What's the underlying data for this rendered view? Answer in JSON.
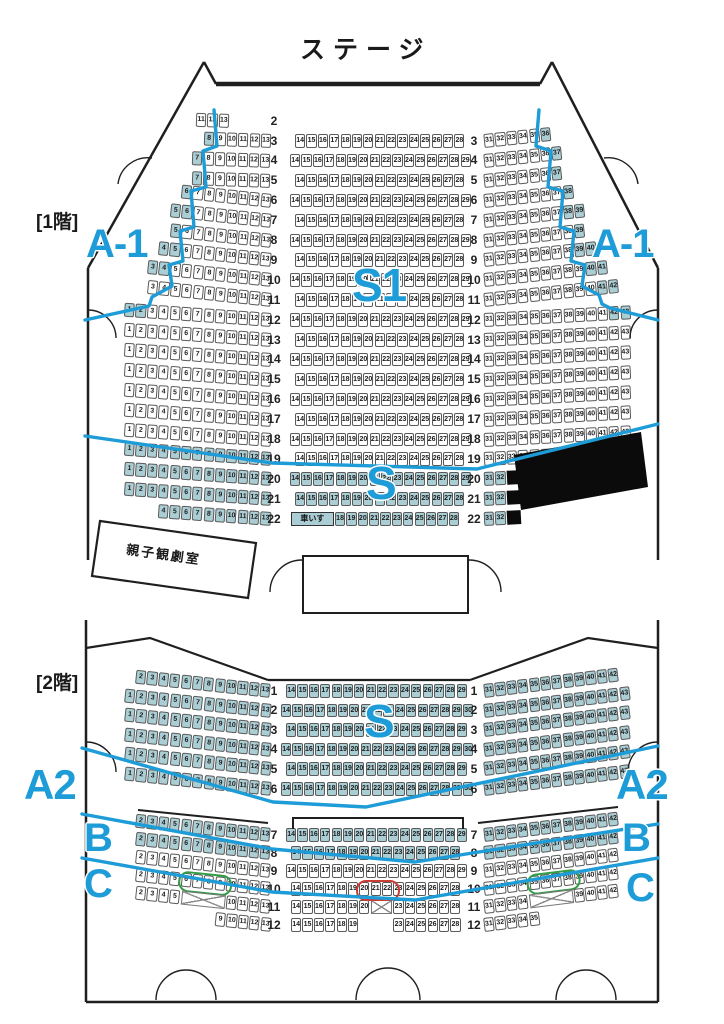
{
  "theme": {
    "teal": "#abced5",
    "blue": "#1e9cd7",
    "red": "#cc3b35",
    "green": "#2f9e44"
  },
  "strings": {
    "wheelchair": "車いす"
  },
  "labels": [
    {
      "n": "stage-label",
      "t": "ステージ",
      "x": 300,
      "y": 38,
      "s": 25,
      "c": "#1a1a1a",
      "ls": 8,
      "plain": true
    },
    {
      "n": "floor1-label",
      "t": "[1階]",
      "x": 36,
      "y": 213,
      "s": 19,
      "c": "#1a1a1a",
      "plain": true
    },
    {
      "n": "floor2-label",
      "t": "[2階]",
      "x": 36,
      "y": 674,
      "s": 19,
      "c": "#1a1a1a",
      "plain": true
    },
    {
      "n": "family-room-label",
      "t": "親子観劇室",
      "x": 126,
      "y": 548,
      "s": 13,
      "c": "#1a1a1a",
      "rot": 8,
      "ls": 2,
      "plain": true
    },
    {
      "n": "zone-a1-left",
      "t": "A-1",
      "x": 86,
      "y": 224,
      "s": 40
    },
    {
      "n": "zone-a1-right",
      "t": "A-1",
      "x": 592,
      "y": 224,
      "s": 40
    },
    {
      "n": "zone-s1",
      "t": "S1",
      "x": 352,
      "y": 262,
      "s": 46
    },
    {
      "n": "zone-s-floor1",
      "t": "S",
      "x": 366,
      "y": 460,
      "s": 46
    },
    {
      "n": "zone-s-floor2",
      "t": "S",
      "x": 364,
      "y": 698,
      "s": 46
    },
    {
      "n": "zone-a2-left",
      "t": "A2",
      "x": 24,
      "y": 764,
      "s": 42
    },
    {
      "n": "zone-a2-right",
      "t": "A2",
      "x": 616,
      "y": 764,
      "s": 42
    },
    {
      "n": "zone-b-left",
      "t": "B",
      "x": 84,
      "y": 818,
      "s": 40
    },
    {
      "n": "zone-b-right",
      "t": "B",
      "x": 622,
      "y": 818,
      "s": 40
    },
    {
      "n": "zone-c-left",
      "t": "C",
      "x": 84,
      "y": 864,
      "s": 40
    },
    {
      "n": "zone-c-right",
      "t": "C",
      "x": 626,
      "y": 868,
      "s": 40
    }
  ],
  "floors": [
    {
      "name": "1F",
      "rows": [
        {
          "n": "2",
          "y": 114,
          "lab": "L",
          "L": {
            "x": 196,
            "r": 2,
            "o": "R",
            "s": "11-13"
          }
        },
        {
          "n": "3",
          "y": 134,
          "lab": "LR",
          "L": {
            "x": 203.8,
            "r": 2,
            "o": "R",
            "s": "8-13",
            "hl": "8"
          },
          "C": {
            "x": 295,
            "s": "14-28"
          },
          "R": {
            "x": 484,
            "r": -6,
            "o": "L",
            "s": "31-36",
            "hl": "36"
          }
        },
        {
          "n": "4",
          "y": 153.9,
          "lab": "LR",
          "L": {
            "x": 192.4,
            "r": 2,
            "o": "R",
            "s": "7-13",
            "hl": "7"
          },
          "C": {
            "x": 290,
            "s": "14-29"
          },
          "R": {
            "x": 484,
            "r": -6,
            "o": "L",
            "s": "31-37",
            "hl": "37"
          }
        },
        {
          "n": "5",
          "y": 173.8,
          "lab": "LR",
          "L": {
            "x": 192.4,
            "r": 2,
            "o": "R",
            "s": "7-13",
            "hl": "7"
          },
          "C": {
            "x": 295,
            "s": "14-28"
          },
          "R": {
            "x": 484,
            "r": -6,
            "o": "L",
            "s": "31-37",
            "hl": "37"
          }
        },
        {
          "n": "6",
          "y": 193.7,
          "lab": "LR",
          "L": {
            "x": 181,
            "r": 6,
            "o": "R",
            "s": "6-13",
            "hl": "6"
          },
          "C": {
            "x": 290,
            "s": "14-29"
          },
          "R": {
            "x": 484,
            "r": -6,
            "o": "L",
            "s": "31-38",
            "hl": "38"
          }
        },
        {
          "n": "7",
          "y": 213.6,
          "lab": "LR",
          "L": {
            "x": 169.6,
            "r": 6,
            "o": "R",
            "s": "5-13",
            "hl": "5-6"
          },
          "C": {
            "x": 295,
            "s": "14-28"
          },
          "R": {
            "x": 484,
            "r": -6,
            "o": "L",
            "s": "31-39",
            "hl": "38-39"
          }
        },
        {
          "n": "8",
          "y": 233.5,
          "lab": "LR",
          "L": {
            "x": 169.6,
            "r": 6,
            "o": "R",
            "s": "5-13",
            "hl": "5"
          },
          "C": {
            "x": 290,
            "s": "14-29"
          },
          "R": {
            "x": 484,
            "r": -6,
            "o": "L",
            "s": "31-39",
            "hl": "39"
          }
        },
        {
          "n": "9",
          "y": 253.4,
          "lab": "LR",
          "L": {
            "x": 158.2,
            "r": 6,
            "o": "R",
            "s": "4-13",
            "hl": "4-5"
          },
          "C": {
            "x": 295,
            "s": "14-28"
          },
          "R": {
            "x": 484,
            "r": -6,
            "o": "L",
            "s": "31-40",
            "hl": "39-40"
          }
        },
        {
          "n": "10",
          "y": 273.3,
          "lab": "LR",
          "L": {
            "x": 146.8,
            "r": 6,
            "o": "R",
            "s": "3-13",
            "hl": "3-4"
          },
          "C": {
            "x": 290,
            "s": "14-29"
          },
          "R": {
            "x": 484,
            "r": -6,
            "o": "L",
            "s": "31-41",
            "hl": "40-41"
          }
        },
        {
          "n": "11",
          "y": 293.2,
          "lab": "LR",
          "L": {
            "x": 146.8,
            "r": 6,
            "o": "R",
            "s": "3-13"
          },
          "C": {
            "x": 295,
            "s": "14-28"
          },
          "R": {
            "x": 484,
            "r": -6,
            "o": "L",
            "s": "31-42",
            "hl": "41-42"
          }
        },
        {
          "n": "12",
          "y": 313.1,
          "lab": "LR",
          "L": {
            "x": 124,
            "r": 4,
            "o": "R",
            "s": "1-13",
            "hl": "1-2"
          },
          "C": {
            "x": 290,
            "s": "14-29"
          },
          "R": {
            "x": 484,
            "r": -3,
            "o": "L",
            "s": "31-43",
            "hl": "42-43"
          }
        },
        {
          "n": "13",
          "y": 333,
          "lab": "LR",
          "L": {
            "x": 124,
            "r": 4,
            "o": "R",
            "s": "1-13"
          },
          "C": {
            "x": 295,
            "s": "14-28"
          },
          "R": {
            "x": 484,
            "r": -3,
            "o": "L",
            "s": "31-43"
          }
        },
        {
          "n": "14",
          "y": 352.9,
          "lab": "LR",
          "L": {
            "x": 124,
            "r": 4,
            "o": "R",
            "s": "1-13"
          },
          "C": {
            "x": 290,
            "s": "14-29"
          },
          "R": {
            "x": 484,
            "r": -3,
            "o": "L",
            "s": "31-43"
          }
        },
        {
          "n": "15",
          "y": 372.8,
          "lab": "LR",
          "L": {
            "x": 124,
            "r": 4,
            "o": "R",
            "s": "1-13"
          },
          "C": {
            "x": 295,
            "s": "14-28"
          },
          "R": {
            "x": 484,
            "r": -3,
            "o": "L",
            "s": "31-43"
          }
        },
        {
          "n": "16",
          "y": 392.7,
          "lab": "LR",
          "L": {
            "x": 124,
            "r": 4,
            "o": "R",
            "s": "1-13"
          },
          "C": {
            "x": 290,
            "s": "14-29"
          },
          "R": {
            "x": 484,
            "r": -3,
            "o": "L",
            "s": "31-43"
          }
        },
        {
          "n": "17",
          "y": 412.6,
          "lab": "LR",
          "L": {
            "x": 124,
            "r": 4,
            "o": "R",
            "s": "1-13"
          },
          "C": {
            "x": 295,
            "s": "14-28"
          },
          "R": {
            "x": 484,
            "r": -3,
            "o": "L",
            "s": "31-43"
          }
        },
        {
          "n": "18",
          "y": 432.5,
          "lab": "LR",
          "L": {
            "x": 124,
            "r": 4,
            "o": "R",
            "s": "1-13"
          },
          "C": {
            "x": 290,
            "s": "14-29"
          },
          "R": {
            "x": 484,
            "r": -3,
            "o": "L",
            "s": "31-43"
          }
        },
        {
          "n": "19",
          "y": 452.4,
          "lab": "LR",
          "L": {
            "x": 124,
            "r": 4,
            "o": "R",
            "s": "1-13",
            "hl": "*"
          },
          "C": {
            "x": 295,
            "s": "14-28"
          },
          "R": {
            "x": 484,
            "r": -3,
            "o": "L",
            "s": "31-41"
          }
        },
        {
          "n": "20",
          "y": 472.3,
          "lab": "LR",
          "L": {
            "x": 124,
            "r": 4,
            "o": "R",
            "s": "1-13",
            "hl": "*"
          },
          "C": {
            "x": 290,
            "s": "14-29",
            "hl": "*"
          },
          "R": {
            "x": 484,
            "r": -3,
            "o": "L",
            "s": "31-32,B",
            "hl": "*"
          }
        },
        {
          "n": "21",
          "y": 492.2,
          "lab": "LR",
          "L": {
            "x": 124,
            "r": 4,
            "o": "R",
            "s": "1-13",
            "hl": "*"
          },
          "C": {
            "x": 295,
            "s": "14-28",
            "hl": "*"
          },
          "R": {
            "x": 484,
            "r": -3,
            "o": "L",
            "s": "31-32,B",
            "hl": "*"
          }
        },
        {
          "n": "22",
          "y": 512.1,
          "lab": "LR",
          "L": {
            "x": 158.2,
            "r": 4,
            "o": "R",
            "s": "4-13",
            "hl": "*"
          },
          "C": {
            "x": 291,
            "s": "W,18-28",
            "hl": "*"
          },
          "R": {
            "x": 484,
            "r": -3,
            "o": "L",
            "s": "31-32,B",
            "hl": "*"
          }
        }
      ]
    },
    {
      "name": "2F",
      "rows": [
        {
          "n": "1",
          "y": 684,
          "lab": "LR",
          "L": {
            "x": 135.4,
            "r": 6,
            "o": "R",
            "s": "2-13",
            "hl": "*"
          },
          "C": {
            "x": 286,
            "s": "14-29",
            "hl": "*"
          },
          "R": {
            "x": 484,
            "r": -7,
            "o": "L",
            "s": "31-42",
            "hl": "*"
          }
        },
        {
          "n": "2",
          "y": 703.6,
          "lab": "LR",
          "L": {
            "x": 124,
            "r": 6,
            "o": "R",
            "s": "1-13",
            "hl": "*"
          },
          "C": {
            "x": 281,
            "s": "14-30",
            "hl": "*"
          },
          "R": {
            "x": 484,
            "r": -7,
            "o": "L",
            "s": "31-43",
            "hl": "*"
          }
        },
        {
          "n": "3",
          "y": 723.2,
          "lab": "LR",
          "L": {
            "x": 124,
            "r": 6,
            "o": "R",
            "s": "1-13",
            "hl": "*"
          },
          "C": {
            "x": 286,
            "s": "14-29",
            "hl": "*"
          },
          "R": {
            "x": 484,
            "r": -7,
            "o": "L",
            "s": "31-43",
            "hl": "*"
          }
        },
        {
          "n": "4",
          "y": 742.8,
          "lab": "LR",
          "L": {
            "x": 124,
            "r": 6,
            "o": "R",
            "s": "1-13",
            "hl": "*"
          },
          "C": {
            "x": 281,
            "s": "14-30",
            "hl": "*"
          },
          "R": {
            "x": 484,
            "r": -7,
            "o": "L",
            "s": "31-43",
            "hl": "*"
          }
        },
        {
          "n": "5",
          "y": 762.4,
          "lab": "LR",
          "L": {
            "x": 124,
            "r": 6,
            "o": "R",
            "s": "1-13",
            "hl": "*"
          },
          "C": {
            "x": 286,
            "s": "14-29",
            "hl": "*"
          },
          "R": {
            "x": 484,
            "r": -7,
            "o": "L",
            "s": "31-43",
            "hl": "*"
          }
        },
        {
          "n": "6",
          "y": 782,
          "lab": "LR",
          "L": {
            "x": 124,
            "r": 6,
            "o": "R",
            "s": "1-13",
            "hl": "*"
          },
          "C": {
            "x": 281,
            "s": "14-30",
            "hl": "*"
          },
          "R": {
            "x": 484,
            "r": -7,
            "o": "L",
            "s": "31-43",
            "hl": "*"
          }
        },
        {
          "n": "7",
          "y": 828,
          "lab": "LR",
          "L": {
            "x": 135.4,
            "r": 6,
            "o": "R",
            "s": "2-13",
            "hl": "*"
          },
          "C": {
            "x": 286,
            "s": "14-29",
            "hl": "*"
          },
          "R": {
            "x": 484,
            "r": -7,
            "o": "L",
            "s": "31-42",
            "hl": "*"
          }
        },
        {
          "n": "8",
          "y": 846,
          "lab": "LR",
          "L": {
            "x": 135.4,
            "r": 6,
            "o": "R",
            "s": "2-13",
            "hl": "*"
          },
          "C": {
            "x": 291,
            "s": "14-28",
            "hl": "*"
          },
          "R": {
            "x": 484,
            "r": -7,
            "o": "L",
            "s": "31-42",
            "hl": "*"
          }
        },
        {
          "n": "9",
          "y": 864,
          "lab": "LR",
          "L": {
            "x": 135.4,
            "r": 6,
            "o": "R",
            "s": "2-13"
          },
          "C": {
            "x": 286,
            "s": "14-29"
          },
          "R": {
            "x": 484,
            "r": -7,
            "o": "L",
            "s": "31-42"
          }
        },
        {
          "n": "10",
          "y": 882,
          "lab": "LR",
          "L": {
            "x": 135.4,
            "r": 6,
            "o": "R",
            "s": "2-13",
            "rg": {
              "c": "#2f9e44",
              "a": 6,
              "b": 9
            }
          },
          "C": {
            "x": 291,
            "s": "14-28",
            "rg": {
              "c": "#cc3b35",
              "a": 20,
              "b": 22
            }
          },
          "R": {
            "x": 484,
            "r": -7,
            "o": "L",
            "s": "31-42",
            "rg": {
              "c": "#2f9e44",
              "a": 35,
              "b": 38
            }
          }
        },
        {
          "n": "11",
          "y": 900,
          "lab": "LR",
          "L": {
            "x": 135.4,
            "r": 6,
            "o": "R",
            "s": "2-5,X4,10-13"
          },
          "C": {
            "x": 291,
            "s": "14-20,X2,23-28"
          },
          "R": {
            "x": 484,
            "r": -7,
            "o": "L",
            "s": "31-34,X4,39-42"
          }
        },
        {
          "n": "12",
          "y": 918,
          "lab": "LR",
          "L": {
            "x": 215.2,
            "r": 6,
            "o": "R",
            "s": "9-13"
          },
          "C": {
            "x": 291,
            "s": "14-19,G3,23-28"
          },
          "R": {
            "x": 484,
            "r": -7,
            "o": "L",
            "s": "31-35"
          }
        }
      ]
    }
  ]
}
